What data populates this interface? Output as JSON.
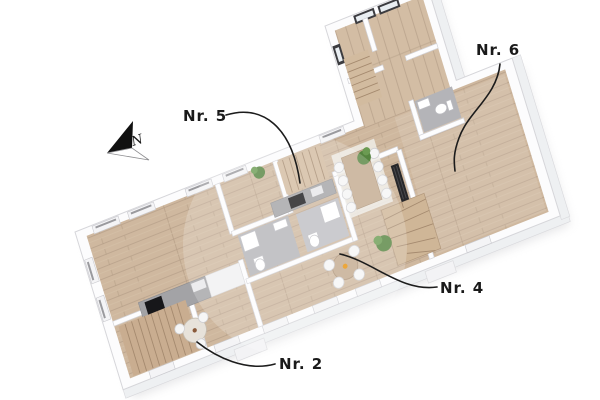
{
  "scene": {
    "kind": "3d-floor-plan-rendering",
    "background": "#ffffff",
    "floor_level": "upper floor with four labeled units"
  },
  "labels": {
    "nr2": {
      "text": "Nr. 2"
    },
    "nr4": {
      "text": "Nr. 4"
    },
    "nr5": {
      "text": "Nr. 5"
    },
    "nr6": {
      "text": "Nr. 6"
    }
  },
  "compass": {
    "letter": "N"
  },
  "colors": {
    "label_text": "#1a1a1a",
    "leader_line": "#1c1c1c",
    "wall_white": "#fdfdfe",
    "wall_face_shade": "#eef0f2",
    "floor_wood": "#cfb89f",
    "plank_line": "#b6a089",
    "tile_grey": "#b4b4b8",
    "counter_grey": "#a3a3a6",
    "appliance_black": "#17171a",
    "stair_wood": "#c9ad90",
    "table_wood": "#c2a98e",
    "plant_green": "#55843f",
    "accent_orange": "#e8920c",
    "compass_black": "#111111"
  }
}
